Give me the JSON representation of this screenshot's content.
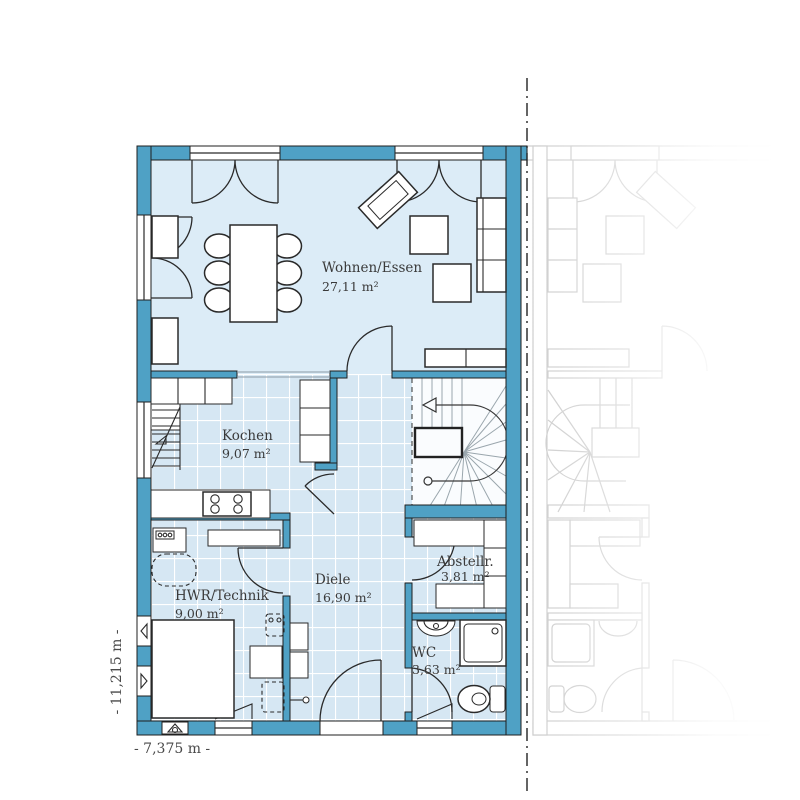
{
  "plan": {
    "rooms": [
      {
        "id": "wohnen-essen",
        "name": "Wohnen/Essen",
        "area": "27,11 m²"
      },
      {
        "id": "kochen",
        "name": "Kochen",
        "area": "9,07 m²"
      },
      {
        "id": "diele",
        "name": "Diele",
        "area": "16,90 m²"
      },
      {
        "id": "hwr-technik",
        "name": "HWR/Technik",
        "area": "9,00 m²"
      },
      {
        "id": "abstellraum",
        "name": "Abstellr.",
        "area": "3,81 m²"
      },
      {
        "id": "wc",
        "name": "WC",
        "area": "3,63 m²"
      }
    ],
    "dimensions": {
      "total_depth": "- 11,215 m -",
      "total_width": "- 7,375 m -"
    },
    "colors": {
      "wall": "#4fa1c5",
      "wall-outline": "#1f1f1f",
      "floor": "#dcecf7",
      "tile": "#d6e7f3",
      "grout": "#ffffff",
      "line": "#2a2a2a",
      "faint": "#c7c7c7",
      "text": "#3a3a3a",
      "stairfloor": "#fafcfe"
    }
  }
}
